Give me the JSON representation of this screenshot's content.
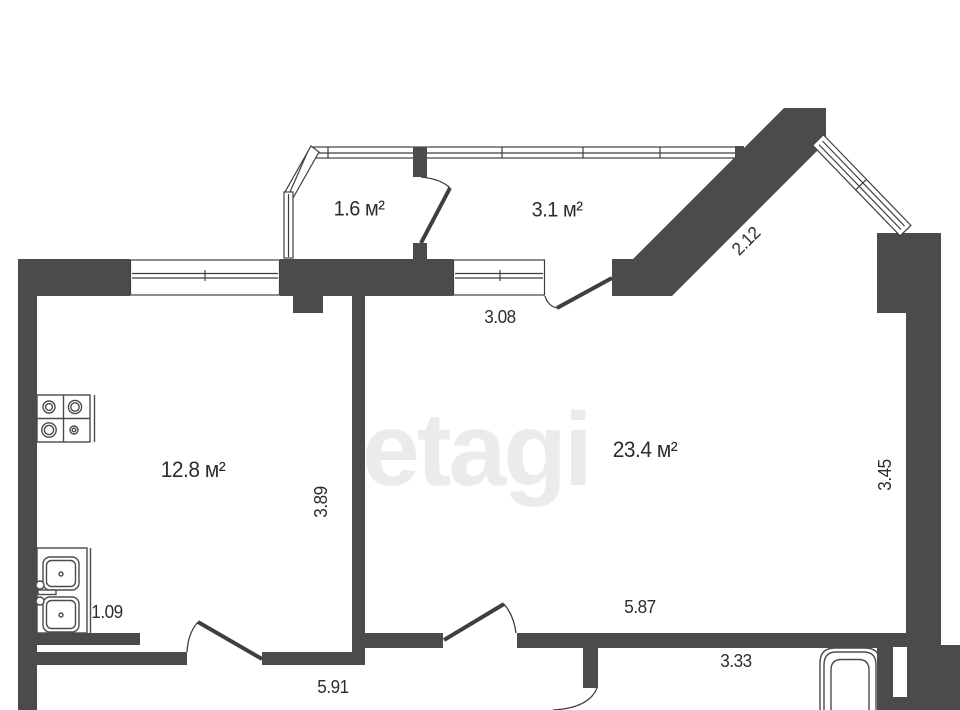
{
  "watermark": {
    "text": "etagi"
  },
  "rooms": [
    {
      "name": "balcony-small",
      "label": "1.6 м²"
    },
    {
      "name": "balcony-large",
      "label": "3.1 м²"
    },
    {
      "name": "kitchen",
      "label": "12.8 м²"
    },
    {
      "name": "living-room",
      "label": "23.4 м²"
    }
  ],
  "dimensions": [
    {
      "edge": "diagonal-wall",
      "label": "2.12"
    },
    {
      "edge": "living-top-window",
      "label": "3.08"
    },
    {
      "edge": "kitchen-height",
      "label": "3.89"
    },
    {
      "edge": "living-right-wall",
      "label": "3.45"
    },
    {
      "edge": "kitchen-sink-counter",
      "label": "1.09"
    },
    {
      "edge": "kitchen-bottom",
      "label": "5.91"
    },
    {
      "edge": "living-bottom",
      "label": "5.87"
    },
    {
      "edge": "bathroom-width",
      "label": "3.33"
    }
  ],
  "fixtures": [
    {
      "icon": "stove-icon"
    },
    {
      "icon": "sink-icon"
    },
    {
      "icon": "bathtub-icon"
    }
  ],
  "colors": {
    "wall": "#4b4b4d",
    "line": "#3f3f41",
    "label_text": "#2d2d2f",
    "watermark": "#ebebee",
    "background": "#ffffff"
  }
}
